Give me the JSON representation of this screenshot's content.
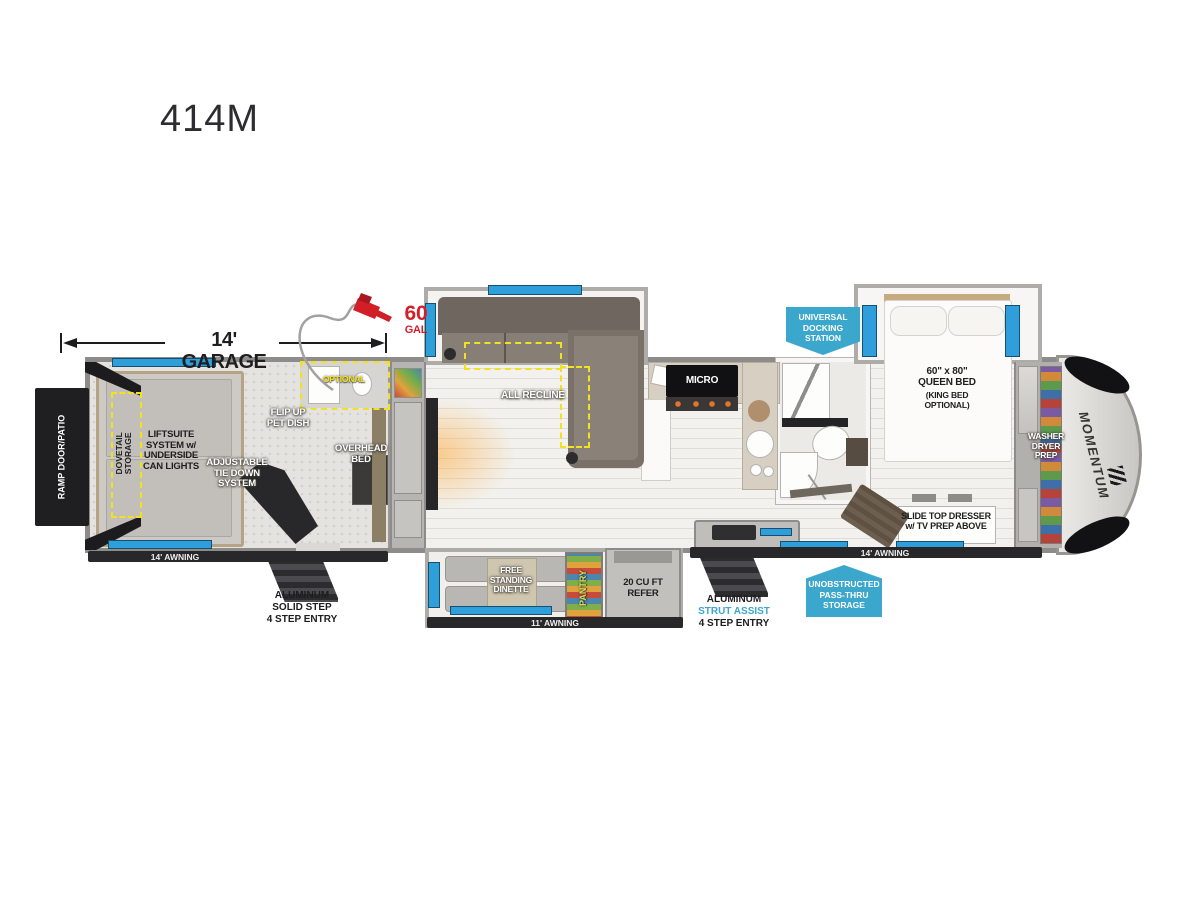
{
  "title": "414M",
  "colors": {
    "badge_blue": "#3ba7cd",
    "window_blue": "#2f9fdc",
    "highlight_yellow": "#f2e023",
    "brand_red": "#d21f27"
  },
  "dimensions": {
    "garage": "14' GARAGE"
  },
  "fuel": {
    "amount": "60",
    "unit": "GAL"
  },
  "garage": {
    "ramp_door": "RAMP DOOR/PATIO",
    "dovetail": "DOVETAIL\nSTORAGE",
    "liftsuite": "LIFTSUITE\nSYSTEM w/\nUNDERSIDE\nCAN LIGHTS",
    "tie_down": "ADJUSTABLE\nTIE DOWN\nSYSTEM",
    "pet_dish": "FLIP UP\nPET DISH",
    "overhead_bed": "OVERHEAD\nBED",
    "optional_bath": "OPTIONAL",
    "awning": "14' AWNING",
    "steps": {
      "l1": "ALUMINUM",
      "l2": "SOLID STEP",
      "l3": "4 STEP ENTRY"
    }
  },
  "living": {
    "sofa": "ALL RECLINE"
  },
  "kitchen": {
    "microwave": "MICRO",
    "pantry": "PANTRY",
    "refrigerator": "20 CU FT\nREFER",
    "dinette": "FREE\nSTANDING\nDINETTE",
    "awning": "11' AWNING",
    "steps": {
      "l1": "ALUMINUM",
      "l2": "STRUT ASSIST",
      "l3": "4 STEP ENTRY"
    }
  },
  "bedroom": {
    "bed": "60\" x 80\"\nQUEEN BED",
    "bed_option": "(KING BED\nOPTIONAL)",
    "dresser": "SLIDE TOP DRESSER\nw/ TV PREP ABOVE",
    "washer_dryer": "WASHER\nDRYER\nPREP",
    "awning": "14' AWNING"
  },
  "badges": {
    "docking": "UNIVERSAL\nDOCKING\nSTATION",
    "pass_thru": "UNOBSTRUCTED\nPASS-THRU\nSTORAGE"
  },
  "brand": "MOMENTUM"
}
